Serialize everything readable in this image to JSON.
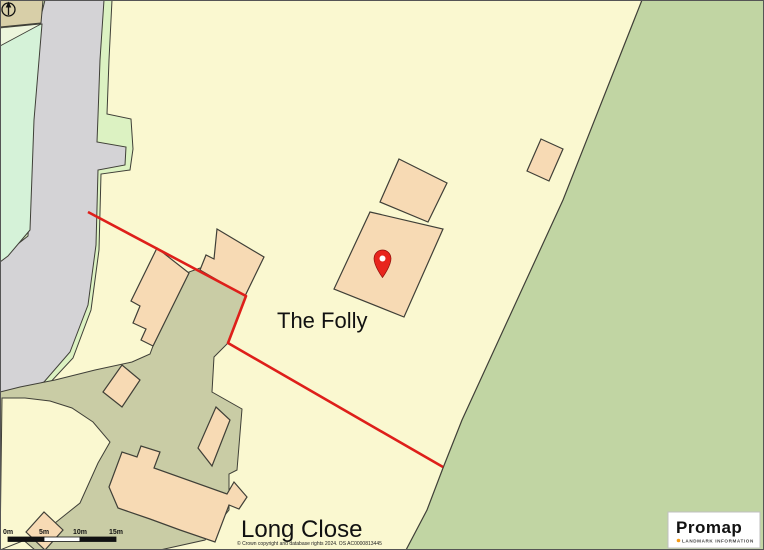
{
  "map": {
    "labels": {
      "property_main": "The Folly",
      "property_neighbour": "Long Close"
    },
    "marker": {
      "type": "location-pin",
      "color": "#E8251D"
    },
    "boundary": {
      "color": "#DE1F1A",
      "style": "solid"
    }
  },
  "scale_bar": {
    "ticks": [
      "0m",
      "5m",
      "10m",
      "15m"
    ]
  },
  "attribution": {
    "copyright": "© Crown copyright and database rights 2024. OS AC0000813445"
  },
  "branding": {
    "logo_text": "Promap",
    "logo_subtitle": "LANDMARK INFORMATION",
    "logo_dot_color": "#F59C1A"
  },
  "colors": {
    "background": "#FAF8D0",
    "field_green": "#C1D5A3",
    "road_grey": "#D4D3D6",
    "verge_green": "#DCF2C2",
    "mint_green": "#D5F2D8",
    "garden_sage": "#C9CCA5",
    "building_peach": "#F7DAB4",
    "building_tan": "#D8CFA8",
    "outline": "#3F3F37",
    "boundary_red": "#DE1F1A",
    "pin_red": "#E8251D"
  }
}
